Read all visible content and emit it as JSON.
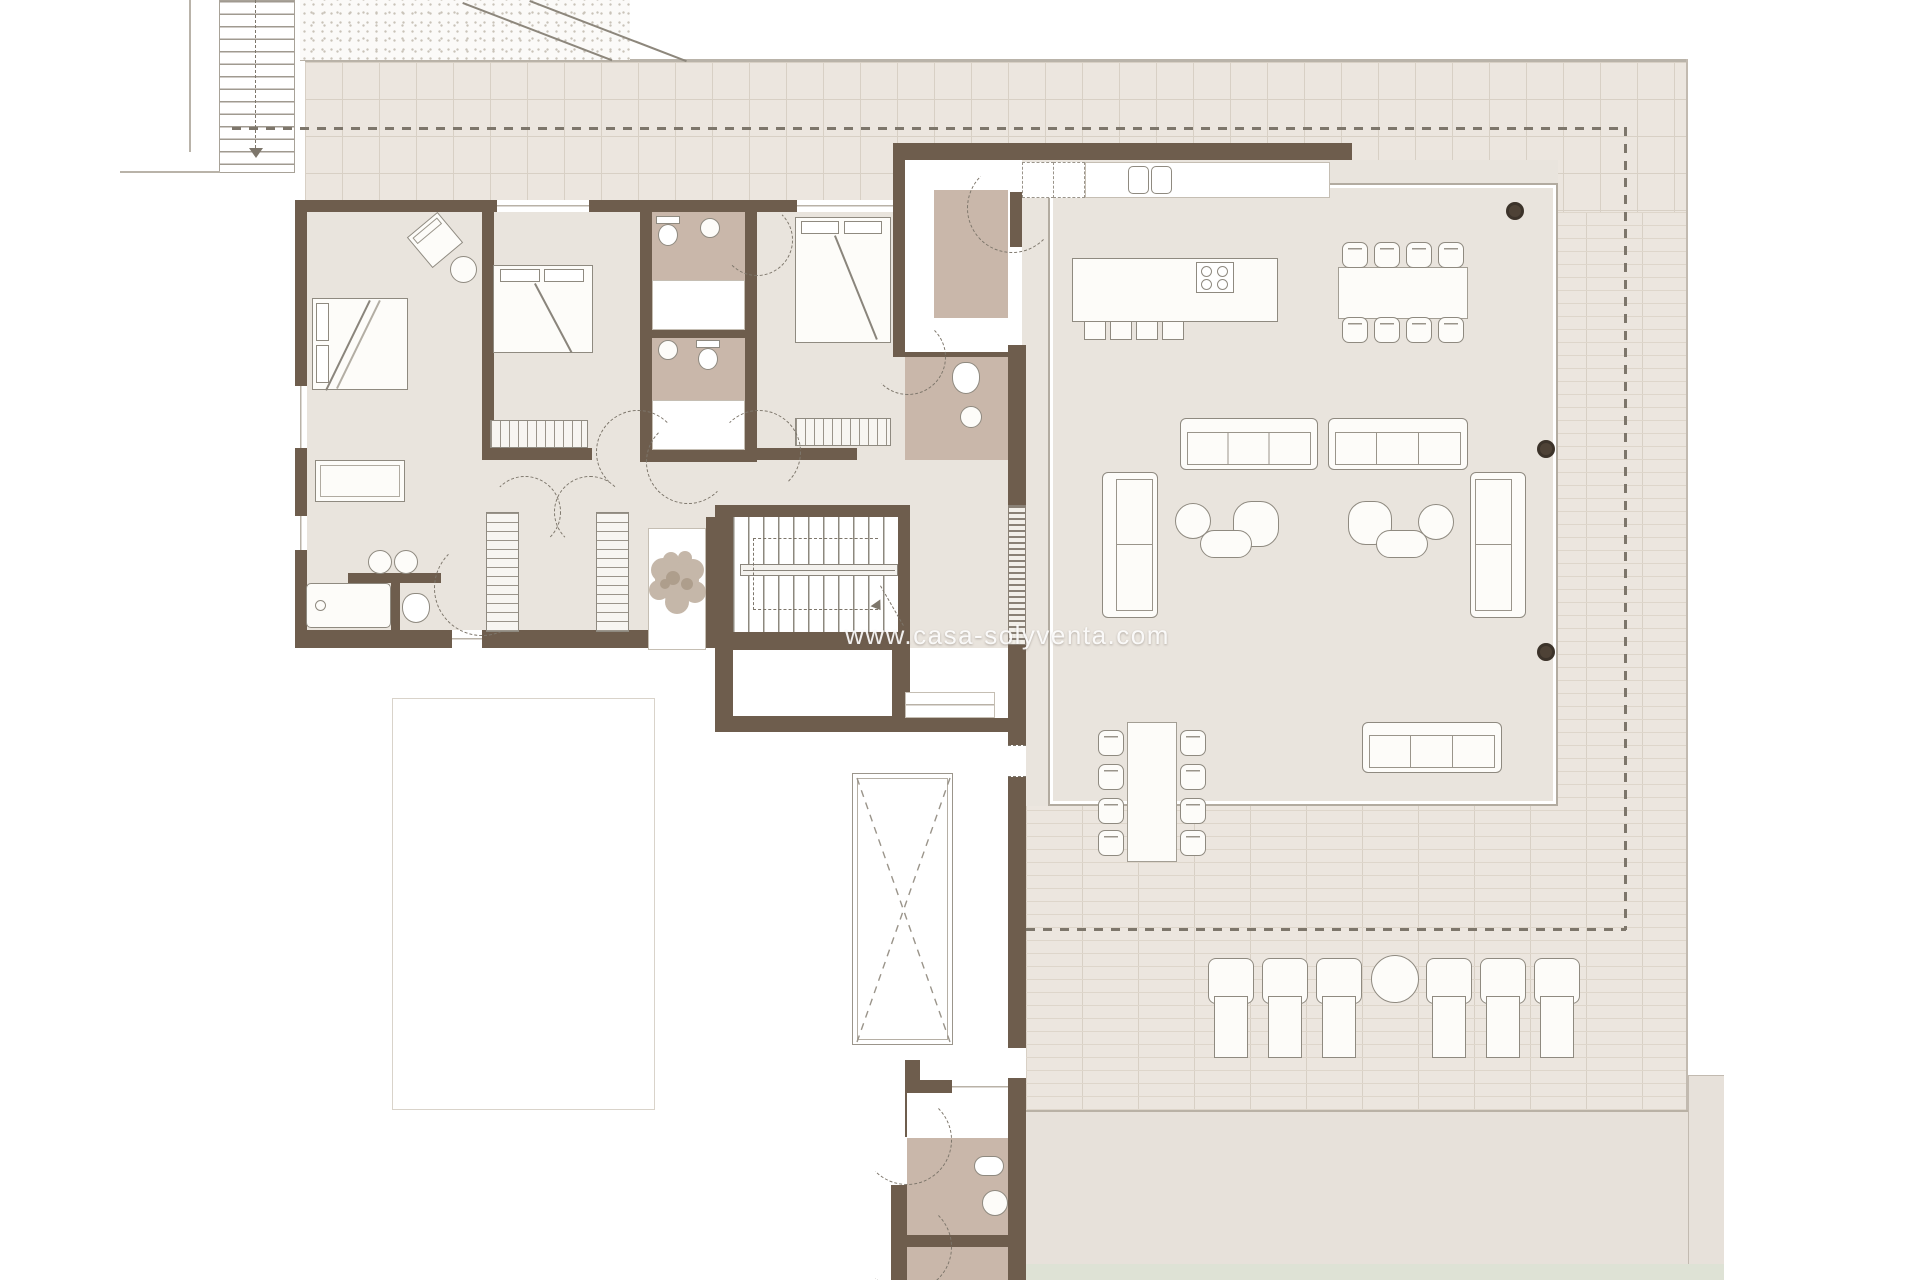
{
  "watermark": {
    "text": "www.casa-solyventa.com"
  },
  "colors": {
    "wall": "#6e5d4d",
    "floor": "#e9e4dd",
    "bath": "#c9b7aa",
    "terrace": "#ece6df",
    "tline": "#d8d0c5",
    "dline": "#ded6cb",
    "fline": "#8f8a80",
    "dash": "#7d766b",
    "column": "#4e4236",
    "gdot": "#c9c3b9"
  },
  "plan": {
    "type": "architectural-floor-plan",
    "regions": [
      "terrace",
      "pool-deck",
      "pool",
      "master-bedroom",
      "bedroom-2",
      "bedroom-3",
      "bathroom-1",
      "bathroom-2",
      "master-bathroom",
      "guest-wc",
      "entry-vestibule",
      "kitchen",
      "dining-area",
      "living-room",
      "hallway",
      "staircase",
      "storage",
      "pool-bathroom",
      "external-stair",
      "gravel-strip"
    ],
    "furniture_icons": [
      "double-bed-icon",
      "wardrobe-icon",
      "closet-icon",
      "sofa-icon",
      "armchair-icon",
      "pouf-icon",
      "coffee-table-icon",
      "kitchen-island-icon",
      "hob-icon",
      "kitchen-sink-icon",
      "bar-stool-icon",
      "dining-table-icon",
      "chair-icon",
      "toilet-icon",
      "washbasin-icon",
      "bathtub-icon",
      "shower-icon",
      "sun-lounger-icon",
      "side-ball-table-icon",
      "planter-tree-icon",
      "stairs-icon",
      "skylight-cross-icon",
      "column-icon"
    ]
  }
}
